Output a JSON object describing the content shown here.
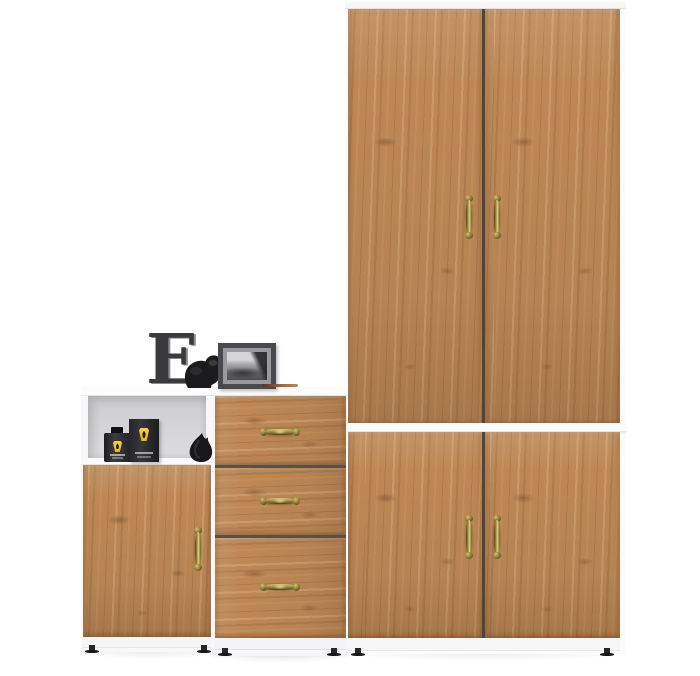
{
  "scene": {
    "description": "Product photo of a modular hallway furniture set: white carcass with golden oak fronts and antique brass handles, styled with black decor objects, on a plain white background",
    "background_color": "#ffffff",
    "palette": {
      "wood": "#bd8855",
      "wood_light": "#e0b886",
      "wood_dark": "#7f522c",
      "carcass_white": "#f8f8f9",
      "gap_shadow": "#4c463e",
      "brass_handle": "#9a8838",
      "decor_charcoal": "#3a3a3c",
      "decor_black": "#1b1b1d",
      "frame_gray": "#4a4a4e",
      "photo_mat_gray": "#9a9a9e",
      "niche_back_gray": "#d2d2d4",
      "shield_yellow": "#f0c020"
    },
    "units": [
      {
        "label": "tall wardrobe with two upper doors and two lower doors",
        "doors_upper": 2,
        "doors_lower": 2,
        "handle_style": "antique brass vertical"
      },
      {
        "label": "chest of three drawers",
        "drawers": 3,
        "handle_style": "antique brass horizontal"
      },
      {
        "label": "side cabinet with open shelf niche and single door",
        "doors": 1,
        "open_shelves": 1,
        "handle_style": "antique brass vertical"
      }
    ],
    "decor": [
      {
        "label": "charcoal letter E ornament",
        "glyph": "E",
        "color": "#3a3a3c"
      },
      {
        "label": "black elephant figurine",
        "color": "#1b1b1d"
      },
      {
        "label": "framed black-and-white landscape photo",
        "color": "#4a4a4e"
      },
      {
        "label": "pencil on chest top",
        "color": "#a5653a"
      },
      {
        "label": "black fragrance bottle with yellow shield badge",
        "color": "#1d1d20"
      },
      {
        "label": "black fragrance box with yellow shield badge",
        "color": "#26262a"
      },
      {
        "label": "black leather pouch",
        "color": "#19191b"
      }
    ]
  }
}
